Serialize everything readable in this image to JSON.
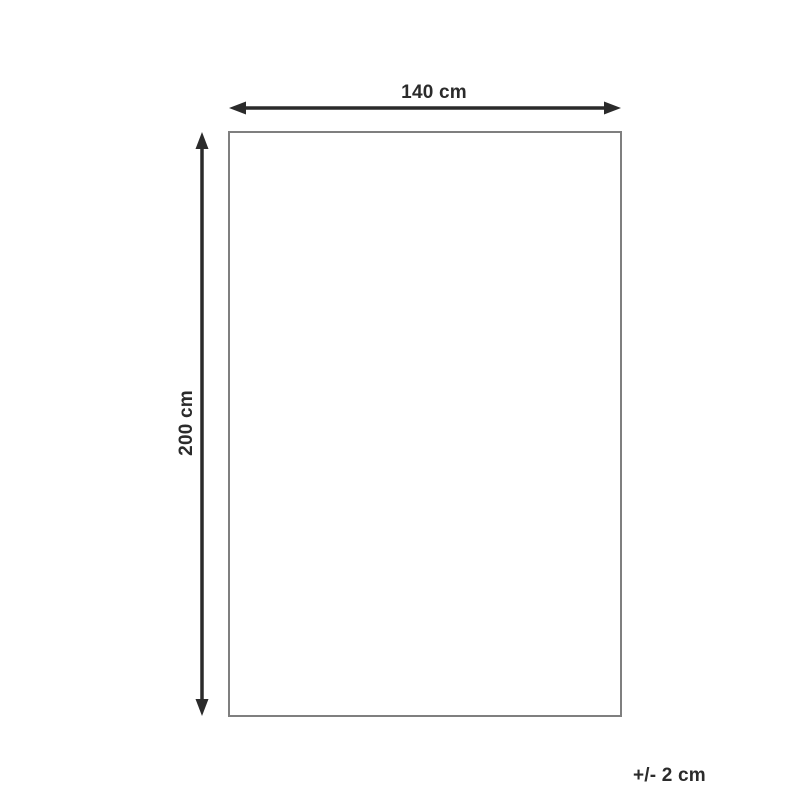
{
  "diagram": {
    "title": "product-dimensions",
    "width_label": "140 cm",
    "height_label": "200 cm",
    "tolerance_label": "+/- 2 cm"
  },
  "colors": {
    "arrow": "#2b2b2b",
    "text": "#2b2b2b",
    "outline": "#7f7f7f",
    "background": "#ffffff"
  }
}
